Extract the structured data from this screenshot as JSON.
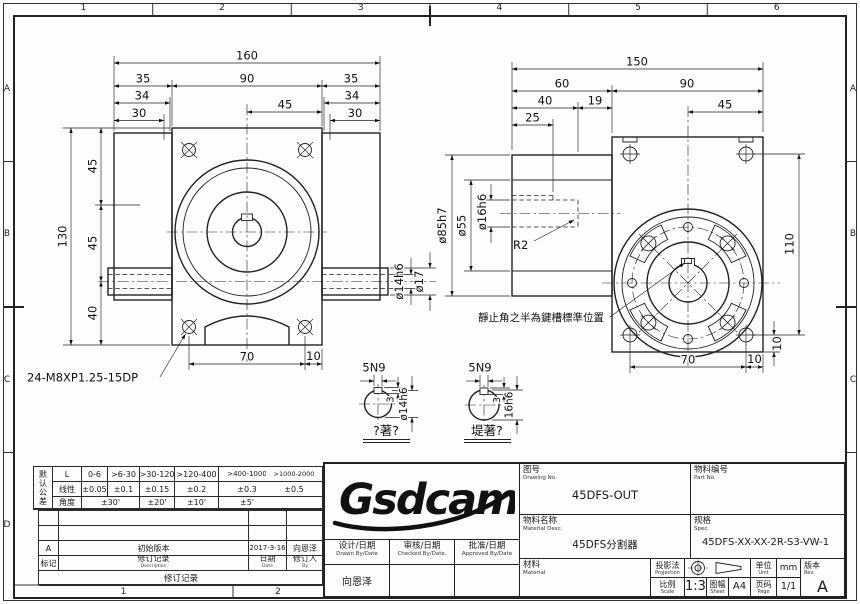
{
  "zones": {
    "top": [
      "1",
      "2",
      "3",
      "4",
      "5",
      "6"
    ],
    "bottom": [
      "1",
      "2"
    ],
    "left": [
      "A",
      "B",
      "C",
      "D"
    ],
    "right": [
      "A",
      "B",
      "C"
    ]
  },
  "front_view": {
    "dim_total_width": "160",
    "dim_left": "35",
    "dim_center": "90",
    "dim_right": "35",
    "dim_34_left": "34",
    "dim_34_right": "34",
    "dim_45_top": "45",
    "dim_30_left": "30",
    "dim_30_right": "30",
    "dim_height": "130",
    "dim_45_upper": "45",
    "dim_45_lower": "45",
    "dim_40": "40",
    "dim_70": "70",
    "dim_10": "10",
    "dim_shaft_bore": "ø14h6",
    "dim_shaft_od": "ø17",
    "thread_callout": "24-M8XP1.25-15DP"
  },
  "side_view": {
    "dim_total_width": "150",
    "dim_60": "60",
    "dim_90": "90",
    "dim_40": "40",
    "dim_19": "19",
    "dim_25": "25",
    "dim_45": "45",
    "dim_pilot": "ø85h7",
    "dim_boss": "ø55",
    "dim_bore": "ø16h6",
    "fillet": "R2",
    "dim_110": "110",
    "dim_10_side": "10",
    "dim_70": "70",
    "dim_10_bottom": "10",
    "keyway_note": "靜止角之半為鍵槽標準位置"
  },
  "details": {
    "input": {
      "key": "5N9",
      "depth": "3",
      "bore": "ø14h6",
      "caption": "?著?"
    },
    "output": {
      "key": "5N9",
      "depth": "3",
      "bore": "16h6",
      "caption": "堤著?"
    }
  },
  "tolerance": {
    "side": "默认公差",
    "length_row": [
      "L",
      "0-6",
      ">6-30",
      ">30-120",
      ">120-400",
      ">400-1000",
      ">1000-2000"
    ],
    "linear_row": [
      "线性",
      "±0.05",
      "±0.1",
      "±0.15",
      "±0.2",
      "±0.3",
      "±0.5"
    ],
    "angle_row": [
      "角度",
      "±30'",
      "±20'",
      "±10'",
      "±5'"
    ]
  },
  "revision": {
    "entry": {
      "mark": "A",
      "desc": "初始版本",
      "date": "2017-3-16",
      "by": "向恩泽"
    },
    "header": {
      "mark": "标记",
      "desc": "修订记录",
      "desc_sub": "Description",
      "date": "日期",
      "date_sub": "Date",
      "by": "修订人",
      "by_sub": "By"
    },
    "title": "修订记录"
  },
  "title_block": {
    "logo": "Gsdcam",
    "drawing_no": {
      "label": "图号",
      "sub": "Drawing No.",
      "value": "45DFS-OUT"
    },
    "part_no": {
      "label": "物料编号",
      "sub": "Part No.",
      "value": ""
    },
    "material_desc": {
      "label": "物料名称",
      "sub": "Material Desc.",
      "value": "45DFS分割器"
    },
    "spec": {
      "label": "规格",
      "sub": "Spec.",
      "value": "45DFS-XX-XX-2R-S3-VW-1"
    },
    "material": {
      "label": "材料",
      "sub": "Material",
      "value": ""
    },
    "drawn": {
      "label": "设计/日期",
      "sub": "Drawn By/Date",
      "value": "向恩泽"
    },
    "checked": {
      "label": "审核/日期",
      "sub": "Checked By/Date.",
      "value": ""
    },
    "approved": {
      "label": "批准/日期",
      "sub": "Approved By/Date",
      "value": ""
    },
    "projection": {
      "label": "投影法",
      "sub": "Projection"
    },
    "scale": {
      "label": "比例",
      "sub": "Scale",
      "value": "1:3"
    },
    "sheet": {
      "label": "图幅",
      "sub": "Sheet",
      "value": "A4"
    },
    "unit": {
      "label": "单位",
      "sub": "Unit",
      "value": "mm"
    },
    "page": {
      "label": "页码",
      "sub": "Page",
      "value": "1/1"
    },
    "rev": {
      "label": "版本",
      "sub": "Rev.",
      "value": "A"
    }
  }
}
